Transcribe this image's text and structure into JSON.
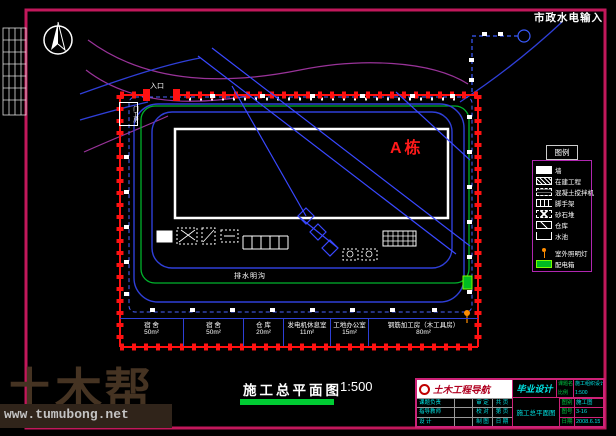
{
  "labels": {
    "municipal_io": "市政水电输入",
    "entrance": "入口",
    "gatehouse": "门卫房",
    "building": "A栋",
    "drain": "排水明沟"
  },
  "rooms": [
    {
      "name": "宿 舍",
      "area": "50m²"
    },
    {
      "name": "宿 舍",
      "area": "50m²"
    },
    {
      "name": "仓 库",
      "area": "20m²"
    },
    {
      "name": "发电机休息室",
      "area": "11m²"
    },
    {
      "name": "工地办公室",
      "area": "15m²"
    },
    {
      "name": "钢筋加工房（木工具房）",
      "area": "80m²"
    }
  ],
  "legend": {
    "title": "图例",
    "items": [
      {
        "icon": "solid-rect-icon",
        "label": "墙"
      },
      {
        "icon": "hatch-rect-icon",
        "label": "在建工程"
      },
      {
        "icon": "dashed-rect-icon",
        "label": "混凝土搅拌机"
      },
      {
        "icon": "comb-icon",
        "label": "脚手架"
      },
      {
        "icon": "cross-hatch-icon",
        "label": "砂石堆"
      },
      {
        "icon": "diag-rect-icon",
        "label": "仓库"
      },
      {
        "icon": "open-rect-icon",
        "label": "水池"
      },
      {
        "icon": "lamp-icon",
        "label": "室外照明灯"
      },
      {
        "icon": "power-box-icon",
        "label": "配电箱"
      }
    ]
  },
  "caption": {
    "title": "施工总平面图",
    "scale": "1:500"
  },
  "titleblock": {
    "org": "土木工程导航",
    "stage": "毕业设计",
    "proj_label": "课题名称",
    "proj_value": "施工组织设计",
    "scale_label": "比例",
    "scale_value": "1:500",
    "drawing_name": "施工总平面图",
    "left_rows": [
      {
        "c1": "课题负责",
        "c3": "审 定",
        "c4": "共 页"
      },
      {
        "c1": "指导教师",
        "c3": "校 对",
        "c4": "第 页"
      },
      {
        "c1": "设  计",
        "c3": "制 图",
        "c4": "日 期"
      }
    ],
    "right_rows": [
      {
        "label": "图别",
        "value": "施工图"
      },
      {
        "label": "图号",
        "value": "3-16"
      },
      {
        "label": "日期",
        "value": "2008.6.15"
      }
    ]
  },
  "watermark": {
    "brand": "土木帮",
    "url": "www.tumubong.net"
  },
  "colors": {
    "border_magenta": "#c2185b",
    "wall_red": "#ff1111",
    "road_blue": "#2f3fd8",
    "water_blue": "#4a63ff",
    "drain_green": "#00b32c",
    "contour_purple": "#993399",
    "building_label_red": "#ff1a1a",
    "caption_bar_green": "#00cc33",
    "titleblock_cyan": "#00e5e5",
    "titleblock_green": "#00cc44"
  }
}
